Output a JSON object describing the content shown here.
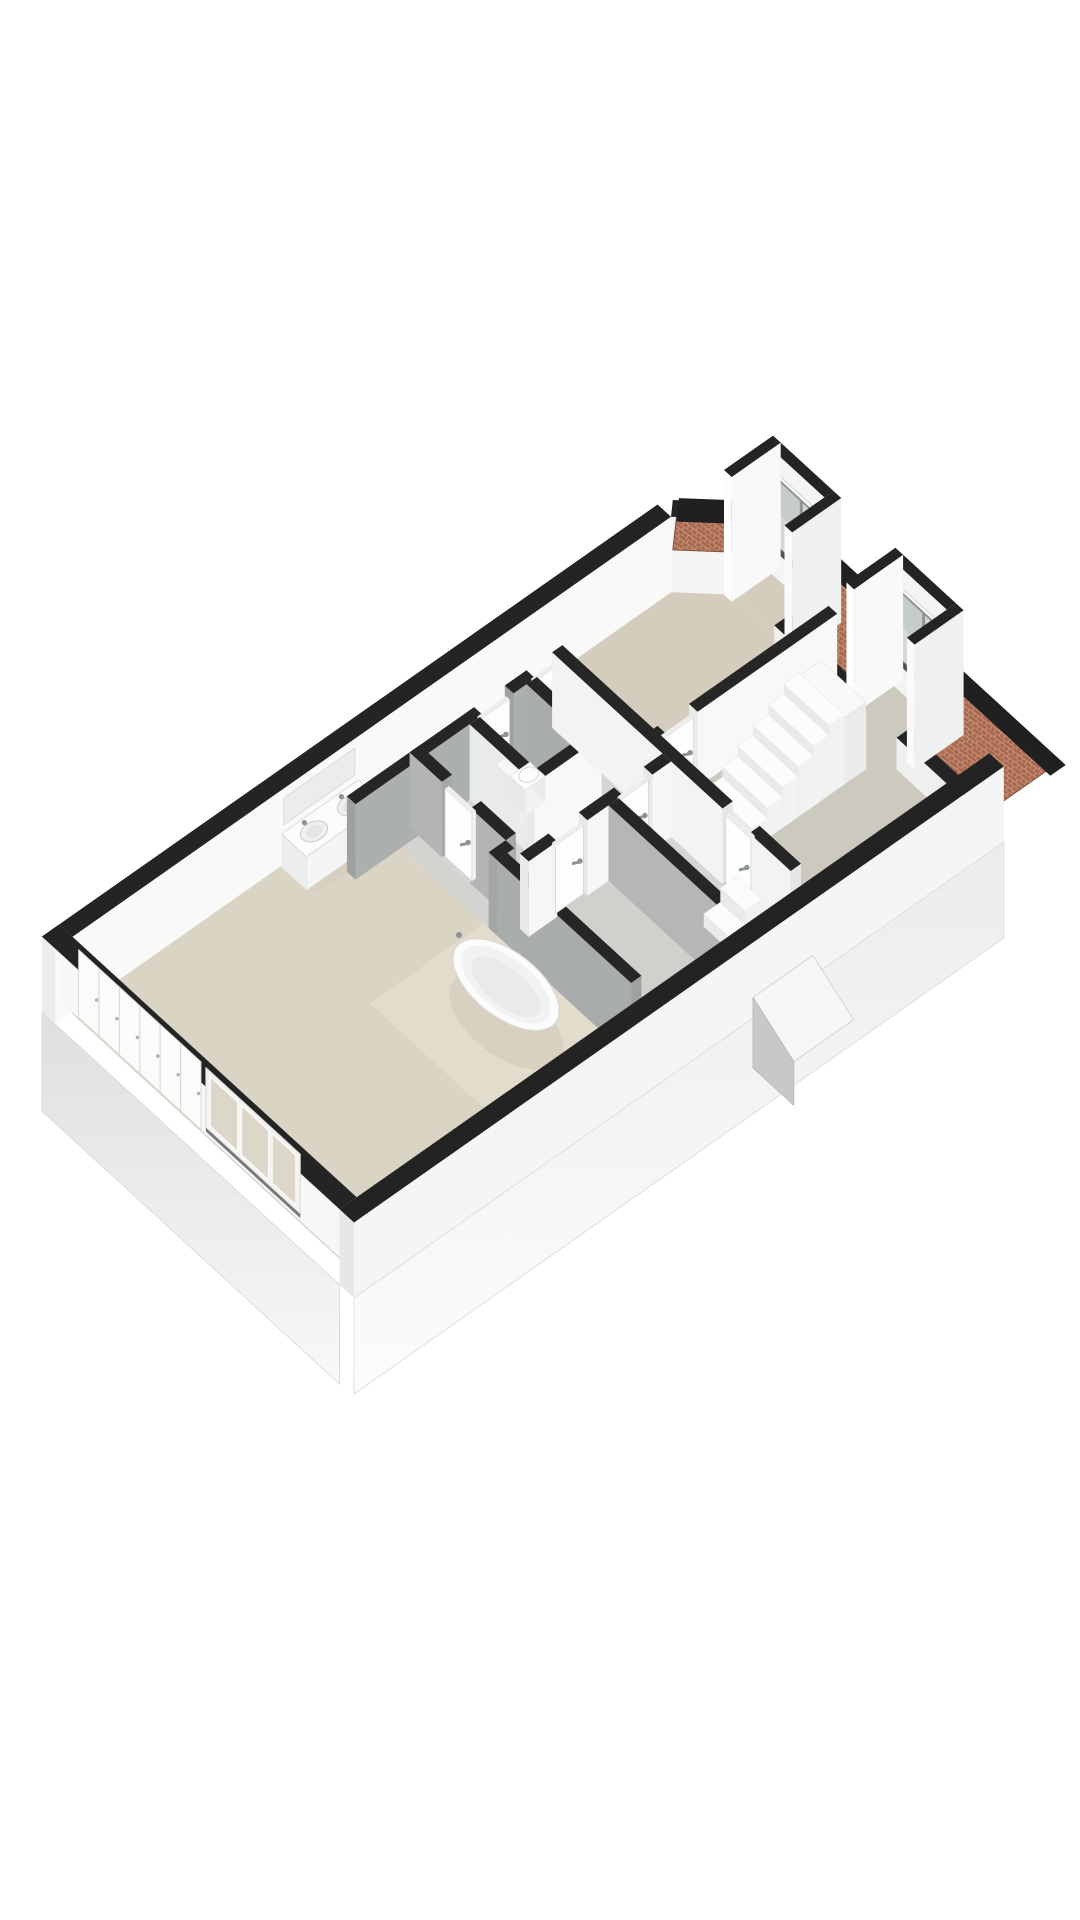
{
  "view": {
    "description": "3D isometric floor plan render, upper storey, no text labels",
    "background": "#ffffff",
    "canvas": {
      "width": 1080,
      "height": 1920
    }
  },
  "projection": {
    "origin": [
      42,
      1012
    ],
    "u": [
      57,
      -40
    ],
    "v": [
      48,
      44
    ],
    "zpx": 64,
    "wall_height": 1.18
  },
  "palette": {
    "wall_top": "#242424",
    "wall_white": "#f8f8f7",
    "wall_gray": "#a9adad",
    "floor_beige": "#dad4c4",
    "floor_gray": "#cccabf",
    "brick": "#a76a51",
    "brick_mortar": "#c9937a",
    "eave_black": "#202020",
    "chrome": "#8d9497",
    "glass_cool": "#c5ccca",
    "glass_warm": "#ddd7c9"
  },
  "scene": [
    {
      "t": "q3",
      "name": "exterior-skin-west",
      "pts": [
        [
          0,
          0,
          0
        ],
        [
          0,
          6.2,
          0
        ],
        [
          0,
          6.2,
          -1.55
        ],
        [
          0,
          0,
          -1.55
        ]
      ],
      "fill": "url(#gradL)",
      "stroke": "#dadbdb"
    },
    {
      "t": "floor",
      "name": "floor-master-bedroom",
      "rect": [
        0.28,
        0.28,
        5.35,
        5.92
      ],
      "fill": "#dad4c4"
    },
    {
      "t": "floor",
      "name": "floor-bathing-area",
      "rect": [
        3.35,
        2.85,
        5.35,
        5.45
      ],
      "fill": "#e2dccd"
    },
    {
      "t": "floor",
      "name": "floor-corridor",
      "rect": [
        4.05,
        0.28,
        8.15,
        0.95
      ],
      "fill": "#d7d0c0"
    },
    {
      "t": "floor",
      "name": "floor-gap-strip",
      "rect": [
        5.35,
        0.95,
        5.65,
        5.92
      ],
      "fill": "#d3d3d0"
    },
    {
      "t": "floor",
      "name": "floor-hallway",
      "rect": [
        5.65,
        0.95,
        8.15,
        3.25
      ],
      "fill": "#d5d6d2"
    },
    {
      "t": "floor",
      "name": "floor-toilet-room",
      "rect": [
        6.55,
        0.95,
        7.55,
        2.3
      ],
      "fill": "#d8d8d4"
    },
    {
      "t": "floor",
      "name": "floor-bedroom-right",
      "rect": [
        8.15,
        0.28,
        11.4,
        2.85
      ],
      "fill": "#d4cdbe"
    },
    {
      "t": "floor",
      "name": "floor-landing",
      "rect": [
        8.15,
        2.85,
        11.4,
        5.92
      ],
      "fill": "#cccabf"
    },
    {
      "t": "floor",
      "name": "floor-room-b1",
      "rect": [
        5.65,
        3.25,
        7.05,
        5.92
      ],
      "fill": "#cfd1cb"
    },
    {
      "t": "floor",
      "name": "floor-room-b2",
      "rect": [
        7.05,
        3.25,
        8.15,
        5.92
      ],
      "fill": "#d6d7d2"
    },
    {
      "t": "floor",
      "name": "floor-dormer-1",
      "rect": [
        11.4,
        0.95,
        12.0,
        2.05
      ],
      "fill": "#d4cdbe"
    },
    {
      "t": "floor",
      "name": "floor-dormer-2",
      "rect": [
        11.4,
        3.5,
        12.0,
        4.6
      ],
      "fill": "#cccabf"
    },
    {
      "t": "wallbox",
      "name": "wall-north",
      "b": [
        0,
        0,
        10.8,
        0.28
      ],
      "h": 1.18,
      "face": "y+",
      "fc": "#f9f9f8",
      "tc": "#242424",
      "cc": "#ececeb"
    },
    {
      "t": "q3",
      "name": "vanity-mirror",
      "pts": [
        [
          4.0,
          0.285,
          0.62
        ],
        [
          5.25,
          0.285,
          0.62
        ],
        [
          5.25,
          0.285,
          1.04
        ],
        [
          4.0,
          0.285,
          1.04
        ]
      ],
      "fill": "#ebedec",
      "stroke": "#d8d9d8"
    },
    {
      "t": "q3",
      "name": "wall-hip-face",
      "pts": [
        [
          10.8,
          0.28,
          0
        ],
        [
          11.4,
          0.88,
          0
        ],
        [
          11.4,
          0.88,
          1.18
        ],
        [
          10.8,
          0.28,
          1.18
        ]
      ],
      "fill": "#f4f5f4"
    },
    {
      "t": "qz",
      "name": "wall-hip-top",
      "pts2": [
        [
          10.8,
          0.28
        ],
        [
          11.4,
          0.88
        ],
        [
          11.6,
          0.68
        ],
        [
          11.0,
          0.08
        ]
      ],
      "z": 1.18,
      "fill": "#242424"
    },
    {
      "t": "qz",
      "name": "roof-brick-hip",
      "pts2": [
        [
          11.0,
          0.08
        ],
        [
          11.6,
          0.68
        ],
        [
          11.99,
          0.29
        ],
        [
          11.39,
          -0.31
        ]
      ],
      "z": 0.4,
      "fill": "url(#brickpat)",
      "stroke": "#7f4c39"
    },
    {
      "t": "qz",
      "name": "roof-eave-hip",
      "pts2": [
        [
          11.39,
          -0.31
        ],
        [
          11.99,
          0.29
        ],
        [
          12.27,
          0.01
        ],
        [
          11.67,
          -0.59
        ]
      ],
      "z": 0.33,
      "fill": "#202020"
    },
    {
      "t": "wallbox",
      "name": "knee-wall-mid",
      "b": [
        11.12,
        2.05,
        11.4,
        3.5
      ],
      "h": 0.5,
      "face": "x-",
      "fc": "#f0f1ef",
      "tc": "#242424",
      "cc": "#e3e4e3"
    },
    {
      "t": "wallbox",
      "name": "knee-wall-right",
      "b": [
        11.12,
        4.6,
        11.4,
        6.2
      ],
      "h": 0.5,
      "face": "x-",
      "fc": "#eef0ee",
      "tc": "#242424",
      "cc": "#e1e2e1"
    },
    {
      "t": "qz",
      "name": "roof-brick-mid",
      "pts2": [
        [
          11.4,
          2.05
        ],
        [
          12.35,
          2.05
        ],
        [
          12.35,
          3.5
        ],
        [
          11.4,
          3.5
        ]
      ],
      "z": 0.4,
      "fill": "url(#brickpat)",
      "stroke": "#7f4c39"
    },
    {
      "t": "qz",
      "name": "roof-brick-right",
      "pts2": [
        [
          11.4,
          4.6
        ],
        [
          12.35,
          4.6
        ],
        [
          12.35,
          6.3
        ],
        [
          11.4,
          6.3
        ]
      ],
      "z": 0.4,
      "fill": "url(#brickpat)",
      "stroke": "#7f4c39"
    },
    {
      "t": "qz",
      "name": "roof-eave",
      "pts2": [
        [
          12.35,
          0.62
        ],
        [
          12.62,
          0.62
        ],
        [
          12.62,
          6.34
        ],
        [
          12.35,
          6.34
        ]
      ],
      "z": 0.33,
      "fill": "#202020"
    },
    {
      "t": "dormer",
      "name": "dormer-1",
      "y0": 0.95,
      "y1": 2.05
    },
    {
      "t": "dormer",
      "name": "dormer-2",
      "y0": 3.5,
      "y1": 4.6
    },
    {
      "t": "vanity",
      "name": "vanity-double-sink",
      "b": [
        3.95,
        0.3,
        5.3,
        0.82
      ],
      "h": 0.52
    },
    {
      "t": "wallbox",
      "name": "wall-corridor-a",
      "b": [
        4.55,
        0.95,
        6.78,
        1.13
      ],
      "h": 1.18,
      "face": "y+",
      "fc": "#abafae",
      "tc": "#262626",
      "cc": "#9da1a0"
    },
    {
      "t": "wallbox",
      "name": "wall-corridor-b",
      "b": [
        7.32,
        0.95,
        7.7,
        1.13
      ],
      "h": 1.18,
      "face": "y+",
      "fc": "#abafae",
      "tc": "#262626",
      "cc": "#9da1a0"
    },
    {
      "t": "door",
      "name": "door-toilet",
      "b": [
        6.8,
        1.0,
        7.3,
        1.07
      ],
      "h": 1.06,
      "handle": [
        7.24,
        1.07,
        0.55
      ]
    },
    {
      "t": "door",
      "name": "door-bedroom-passage",
      "b": [
        7.74,
        1.0,
        8.12,
        1.07
      ],
      "h": 1.06,
      "handle": [
        8.06,
        1.07,
        0.55
      ]
    },
    {
      "t": "wallbox",
      "name": "wall-toilet-west",
      "b": [
        6.55,
        1.13,
        6.73,
        2.3
      ],
      "h": 1.18,
      "face": "x-",
      "fc": "#e9ebea",
      "tc": "#262626",
      "cc": "#dcdedd"
    },
    {
      "t": "wallbox",
      "name": "wall-toilet-east",
      "b": [
        7.55,
        1.13,
        7.73,
        2.3
      ],
      "h": 1.18,
      "face": "x-",
      "fc": "#a8acac",
      "tc": "#262626",
      "cc": "#9b9f9f"
    },
    {
      "t": "wallbox",
      "name": "wall-toilet-south",
      "b": [
        6.55,
        2.3,
        7.73,
        2.48
      ],
      "h": 1.18,
      "face": "y+",
      "fc": "#f7f8f7",
      "tc": "#262626",
      "cc": "#e8e9e8"
    },
    {
      "t": "toilet",
      "name": "toilet",
      "cistern": [
        6.76,
        1.42,
        6.93,
        1.92
      ],
      "ch": 0.62,
      "bowl": [
        6.93,
        1.52,
        7.28,
        1.84
      ],
      "bh": 0.4
    },
    {
      "t": "wallbox",
      "name": "wall-hall-west-a",
      "b": [
        5.65,
        0.95,
        5.83,
        1.62
      ],
      "h": 1.18,
      "face": "x-",
      "fc": "#b2b5b4",
      "tc": "#262626",
      "cc": "#a5a8a7"
    },
    {
      "t": "wallbox",
      "name": "wall-hall-west-b",
      "b": [
        5.65,
        2.22,
        5.83,
        2.95
      ],
      "h": 1.18,
      "face": "x-",
      "fc": "#b2b5b4",
      "tc": "#262626",
      "cc": "#a5a8a7"
    },
    {
      "t": "door",
      "name": "door-master-bedroom",
      "b": [
        5.69,
        1.64,
        5.76,
        2.2
      ],
      "h": 1.06,
      "handle": [
        5.69,
        2.12,
        0.55
      ]
    },
    {
      "t": "wallbox",
      "name": "wall-bedroom-landing-a",
      "b": [
        8.15,
        2.85,
        8.4,
        3.03
      ],
      "h": 1.18,
      "face": "y+",
      "fc": "#f7f8f7",
      "tc": "#262626",
      "cc": "#eaebea"
    },
    {
      "t": "wallbox",
      "name": "wall-bedroom-landing-b",
      "b": [
        8.95,
        2.85,
        11.4,
        3.03
      ],
      "h": 1.18,
      "face": "y+",
      "fc": "#f7f8f7",
      "tc": "#262626",
      "cc": "#eaebea"
    },
    {
      "t": "door",
      "name": "door-bedroom-right",
      "b": [
        8.42,
        2.9,
        8.93,
        2.97
      ],
      "h": 1.06,
      "handle": [
        8.87,
        2.97,
        0.55
      ]
    },
    {
      "t": "wallbox",
      "name": "wall-bath-return",
      "b": [
        5.35,
        2.95,
        5.65,
        3.13
      ],
      "h": 1.18,
      "face": "y+",
      "fc": "#b0b3b2",
      "tc": "#262626",
      "cc": "#a3a6a5"
    },
    {
      "t": "wallbox",
      "name": "wall-bath-partition",
      "b": [
        5.35,
        3.13,
        5.53,
        5.92
      ],
      "h": 1.18,
      "face": "x-",
      "fc": "#a8acac",
      "tc": "#262626",
      "cc": "#9da1a1"
    },
    {
      "t": "tub",
      "name": "bathtub",
      "c": [
        4.52,
        4.3
      ],
      "rx": 0.48,
      "ry": 0.95,
      "z": 0.56,
      "faucet": [
        4.52,
        3.32
      ]
    },
    {
      "t": "stairs",
      "name": "staircase",
      "x0": 8.82,
      "y0": 3.38,
      "y1": 4.32,
      "n": 6,
      "dx": 0.27,
      "h0": 0.16,
      "dh": 0.155,
      "curtail": [
        8.5,
        3.28,
        8.86,
        4.42
      ],
      "top": [
        10.44,
        3.38,
        10.82,
        4.32
      ],
      "topH": 1.05
    },
    {
      "t": "wallbox",
      "name": "wall-hall-east-a",
      "b": [
        8.15,
        0.95,
        8.33,
        4.5
      ],
      "h": 1.18,
      "face": "x-",
      "fc": "#f2f3f2",
      "tc": "#262626",
      "cc": "#e4e5e4"
    },
    {
      "t": "wallbox",
      "name": "wall-hall-east-b",
      "b": [
        8.15,
        5.06,
        8.33,
        5.92
      ],
      "h": 1.18,
      "face": "x-",
      "fc": "#f2f3f2",
      "tc": "#262626",
      "cc": "#e4e5e4"
    },
    {
      "t": "door",
      "name": "door-landing",
      "b": [
        8.19,
        4.52,
        8.26,
        5.04
      ],
      "h": 1.06,
      "handle": [
        8.19,
        4.96,
        0.55
      ]
    },
    {
      "t": "wallbox",
      "name": "wall-b-north-a",
      "b": [
        5.65,
        3.25,
        6.15,
        3.43
      ],
      "h": 1.18,
      "face": "y+",
      "fc": "#f5f6f5",
      "tc": "#262626",
      "cc": "#e7e8e7"
    },
    {
      "t": "wallbox",
      "name": "wall-b-north-b",
      "b": [
        6.68,
        3.25,
        7.3,
        3.43
      ],
      "h": 1.18,
      "face": "y+",
      "fc": "#f5f6f5",
      "tc": "#262626",
      "cc": "#e7e8e7"
    },
    {
      "t": "wallbox",
      "name": "wall-b-north-c",
      "b": [
        7.82,
        3.25,
        8.15,
        3.43
      ],
      "h": 1.18,
      "face": "y+",
      "fc": "#f5f6f5",
      "tc": "#262626",
      "cc": "#e7e8e7"
    },
    {
      "t": "door",
      "name": "door-room-b1",
      "b": [
        6.17,
        3.3,
        6.66,
        3.37
      ],
      "h": 1.06,
      "handle": [
        6.6,
        3.37,
        0.55
      ]
    },
    {
      "t": "door",
      "name": "door-room-b2",
      "b": [
        7.32,
        3.3,
        7.8,
        3.37
      ],
      "h": 1.06,
      "handle": [
        7.74,
        3.37,
        0.55
      ]
    },
    {
      "t": "wallbox",
      "name": "wall-b-mid",
      "b": [
        7.05,
        3.43,
        7.23,
        5.92
      ],
      "h": 1.18,
      "face": "x-",
      "fc": "#b4b7b6",
      "tc": "#262626",
      "cc": "#a6a9a9"
    },
    {
      "t": "steps",
      "name": "steps-lower-stairwell",
      "b": [
        7.5,
        4.88,
        8.08,
        5.4
      ],
      "h1": 0.2,
      "h2": 0.42
    },
    {
      "t": "wallbox",
      "name": "wall-west-end",
      "b": [
        0,
        0,
        0.3,
        6.2
      ],
      "h": 1.18,
      "face": "x+",
      "fc": "#f6f7f6",
      "tc": "#242424",
      "cc": "#eaebea"
    },
    {
      "t": "wardrobe",
      "name": "wardrobe-doors",
      "x": 0.305,
      "y0": 0.4,
      "y1": 2.95,
      "z0": 0.0,
      "z1": 1.06,
      "panels": 6
    },
    {
      "t": "winleft",
      "name": "window-master-bedroom",
      "x": 0.305,
      "y0": 3.05,
      "y1": 5.02,
      "z0": 0.1,
      "z1": 1.04
    },
    {
      "t": "wallbox",
      "name": "wall-south",
      "b": [
        0,
        6.2,
        11.4,
        6.5
      ],
      "h": 1.18,
      "face": "y+",
      "fc": "#f4f5f4",
      "tc": "#232323",
      "cc": "#e6e7e6"
    },
    {
      "t": "q3",
      "name": "exterior-skin-south",
      "pts": [
        [
          0,
          6.5,
          0
        ],
        [
          11.4,
          6.5,
          0
        ],
        [
          11.4,
          6.5,
          -1.5
        ],
        [
          0,
          6.5,
          -1.5
        ]
      ],
      "fill": "url(#gradS)",
      "stroke": "#dcdddd"
    },
    {
      "t": "q3",
      "name": "stairwell-bulkhead-roof",
      "pts": [
        [
          7.0,
          6.5,
          0.32
        ],
        [
          8.05,
          6.5,
          0.32
        ],
        [
          8.05,
          7.35,
          -0.1
        ],
        [
          7.0,
          7.35,
          -0.1
        ]
      ],
      "fill": "#f5f6f5",
      "stroke": "#cfd0d0"
    },
    {
      "t": "q3",
      "name": "stairwell-bulkhead-side",
      "pts": [
        [
          7.0,
          6.5,
          0.32
        ],
        [
          7.0,
          7.35,
          -0.1
        ],
        [
          7.0,
          7.35,
          -0.78
        ],
        [
          7.0,
          6.5,
          -0.78
        ]
      ],
      "fill": "#c7c9c8",
      "stroke": "#b8baba"
    }
  ]
}
